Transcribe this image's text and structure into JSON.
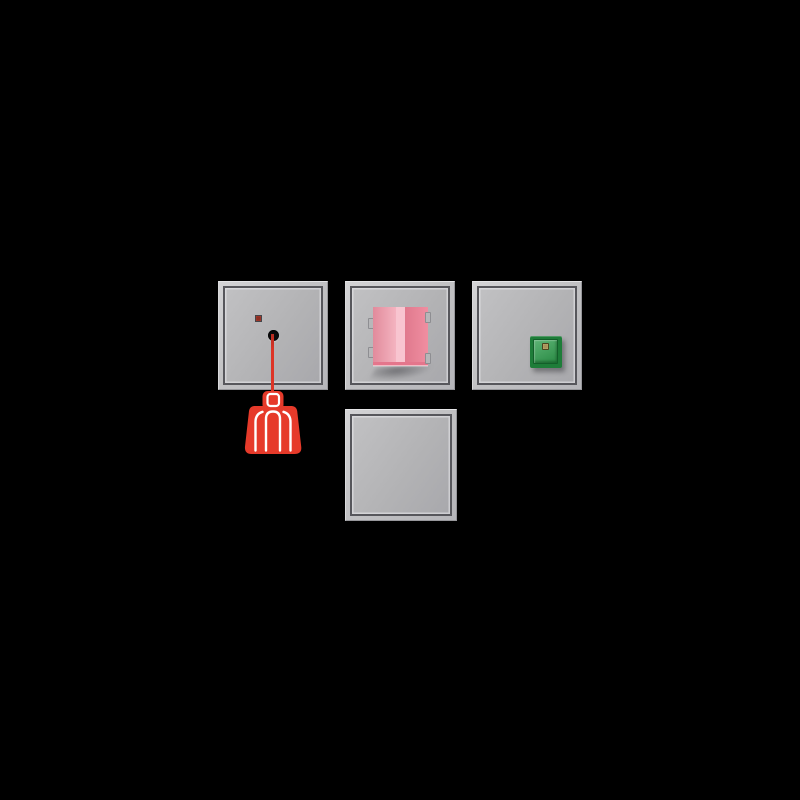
{
  "canvas": {
    "background_color": "#000000"
  },
  "palette": {
    "frame_light_gray": "#c6c6c8",
    "frame_dark_line": "#57575c",
    "plate_gray": "#b3b3b5",
    "alarm_red": "#e63a2a",
    "cord_red": "#dd3527",
    "handle_outline_white": "#ffffff",
    "indicator_led_red": "#8e2e22",
    "hole_black": "#0b0b0d",
    "pink_left_face": "#ef93a5",
    "pink_fold_highlight": "#f8c5d0",
    "pink_right_face": "#ee8196",
    "pink_bottom_edge": "#e4768c",
    "fixing_clip_gray": "#b7b7b9",
    "green_button_frame": "#1e7d39",
    "green_button_face": "#2f9e4e",
    "button_led_amber": "#a8935a"
  },
  "components": [
    {
      "name": "pull-cord-call-switch",
      "elements": [
        "red-indicator-led",
        "cord-outlet-hole",
        "red-pull-cord",
        "red-person-pull-handle"
      ]
    },
    {
      "name": "pink-rocker-module",
      "elements": [
        "pink-folded-rocker",
        "fixing-clips",
        "drop-shadow"
      ]
    },
    {
      "name": "green-button-module",
      "elements": [
        "green-square-button",
        "button-led",
        "drop-shadow"
      ]
    },
    {
      "name": "blank-cover-plate",
      "elements": []
    }
  ]
}
